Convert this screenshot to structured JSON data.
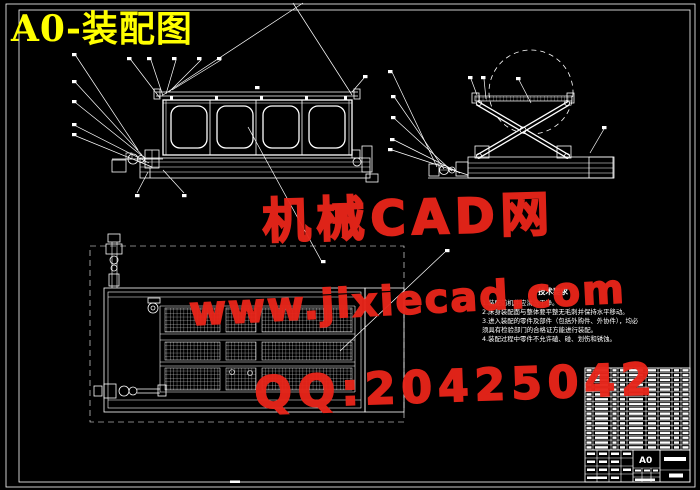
{
  "sheet": {
    "title": "A0-装配图"
  },
  "watermark": {
    "brand": "机械CAD网",
    "website": "www.jixiecad.com",
    "qq": "QQ:20425042",
    "color": "#e8251a"
  },
  "tech_requirements": {
    "title": "技术要求",
    "lines": [
      "1.装配前机件应清洗干净。",
      "2.床身装配面与整体要平整无毛刺并保持水平移动。",
      "3.进入装配的零件及部件（包括外购件、外协件），均必",
      "须具有检验部门的合格证方能进行装配。",
      "4.装配过程中零件不允许磕、碰、划伤和锈蚀。"
    ]
  },
  "title_block": {
    "sheet_size": "A0"
  },
  "colors": {
    "background": "#000000",
    "line": "#ffffff",
    "sheet_title": "#ffff00",
    "watermark": "#e8251a"
  }
}
